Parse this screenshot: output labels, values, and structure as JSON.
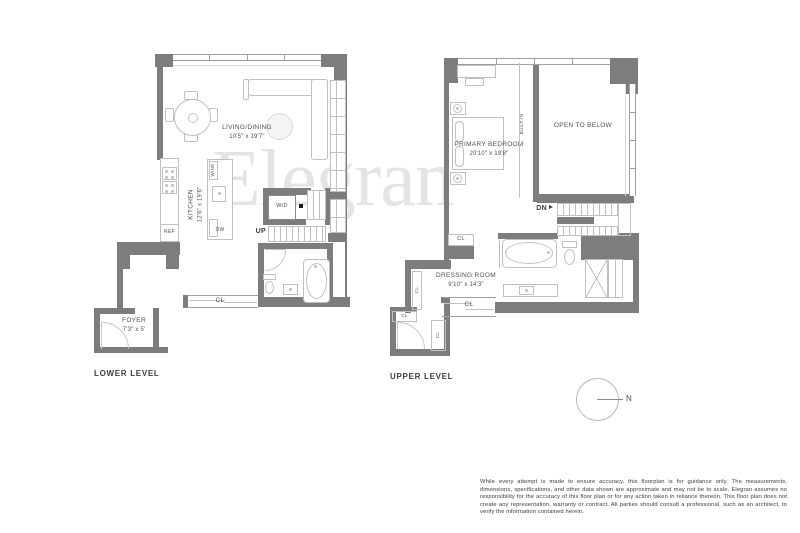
{
  "brand_watermark": "Elegran",
  "colors": {
    "wall": "#7d7d7d",
    "fixture_line": "#c0c0c0",
    "watermark": "#e4e4e4",
    "label_text": "#4f4f4f"
  },
  "lower_level": {
    "title": "LOWER LEVEL",
    "living_dining_name": "LIVING/DINING",
    "living_dining_dims": "10'5\" x 19'7\"",
    "kitchen_name": "KITCHEN",
    "kitchen_dims": "12'6\" x 19'6\"",
    "foyer_name": "FOYER",
    "foyer_dims": "7'3\" x 5'",
    "wine": "WINE",
    "dw": "DW",
    "ref": "REF",
    "wd": "W/D",
    "up": "UP",
    "cl": "CL"
  },
  "upper_level": {
    "title": "UPPER LEVEL",
    "primary_bedroom_name": "PRIMARY BEDROOM",
    "primary_bedroom_dims": "20'10\" x 19'8\"",
    "open_to_below": "OPEN TO BELOW",
    "dressing_room_name": "DRESSING ROOM",
    "dressing_room_dims": "9'10\" x 14'3\"",
    "built_in": "BUILT-IN",
    "dn": "DN",
    "cl": "CL"
  },
  "compass": {
    "north": "N"
  },
  "disclaimer": "While every attempt is made to ensure accuracy, this floorplan is for guidance only. The measurements, dimensions, specifications, and other data shown are approximate and may not be to scale. Elegran assumes no responsibility for the accuracy of this floor plan or for any action taken in reliance thereon. This floor plan does not create any representation, warranty or contract. All parties should consult a professional, such as an architect, to verify the information contained herein."
}
